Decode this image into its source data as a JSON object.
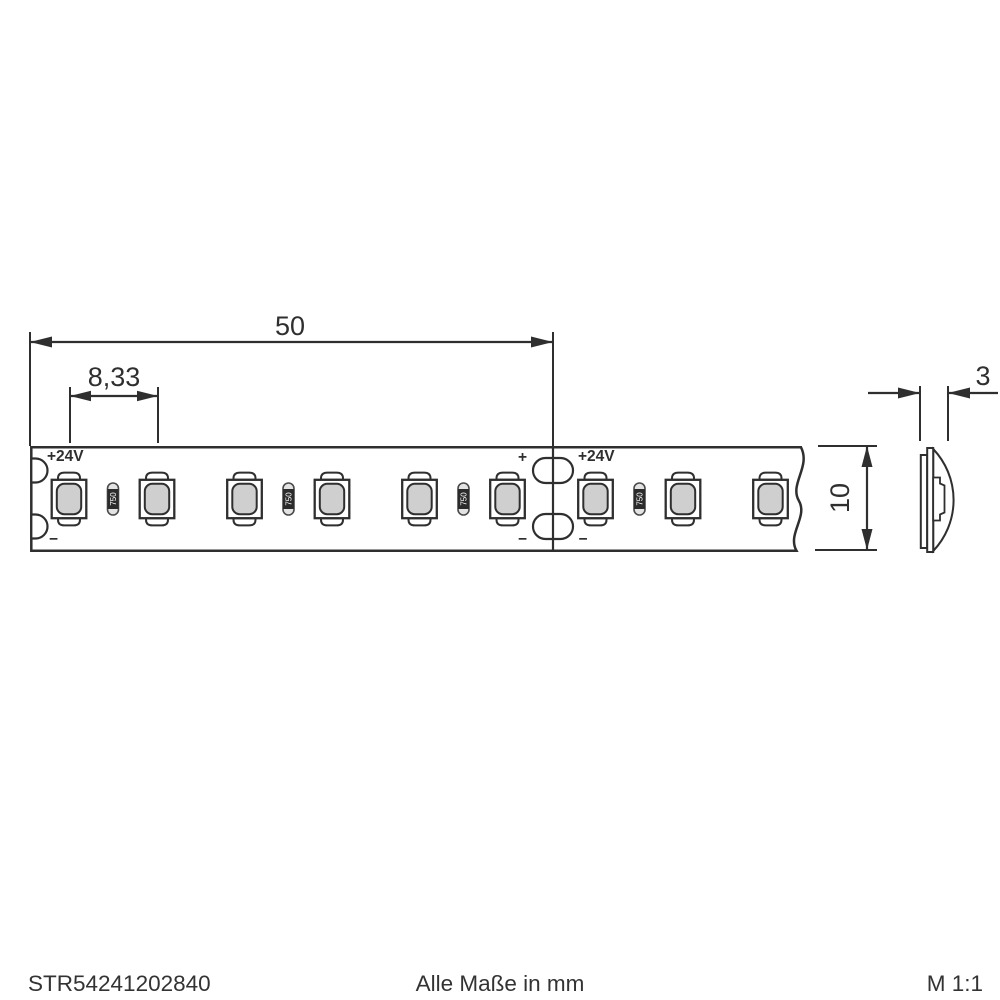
{
  "drawing": {
    "type": "led-strip-dimensional-drawing",
    "dimensions": {
      "section_length": "50",
      "led_pitch": "8,33",
      "strip_width": "10",
      "strip_thickness": "3"
    },
    "strip": {
      "voltage_left": "+24V",
      "voltage_right": "+24V",
      "plus": "+",
      "minus": "−",
      "resistor_marking": "750",
      "led_count": 9,
      "resistor_count": 4
    },
    "colors": {
      "line": "#2f2f2f",
      "led_fill": "#cfcfcf",
      "resistor_band": "#2b2b2b",
      "resistor_body": "#e3e3e3",
      "background": "#ffffff"
    }
  },
  "footer": {
    "part_number": "STR54241202840",
    "units_note": "Alle Maße in mm",
    "scale": "M 1:1"
  }
}
